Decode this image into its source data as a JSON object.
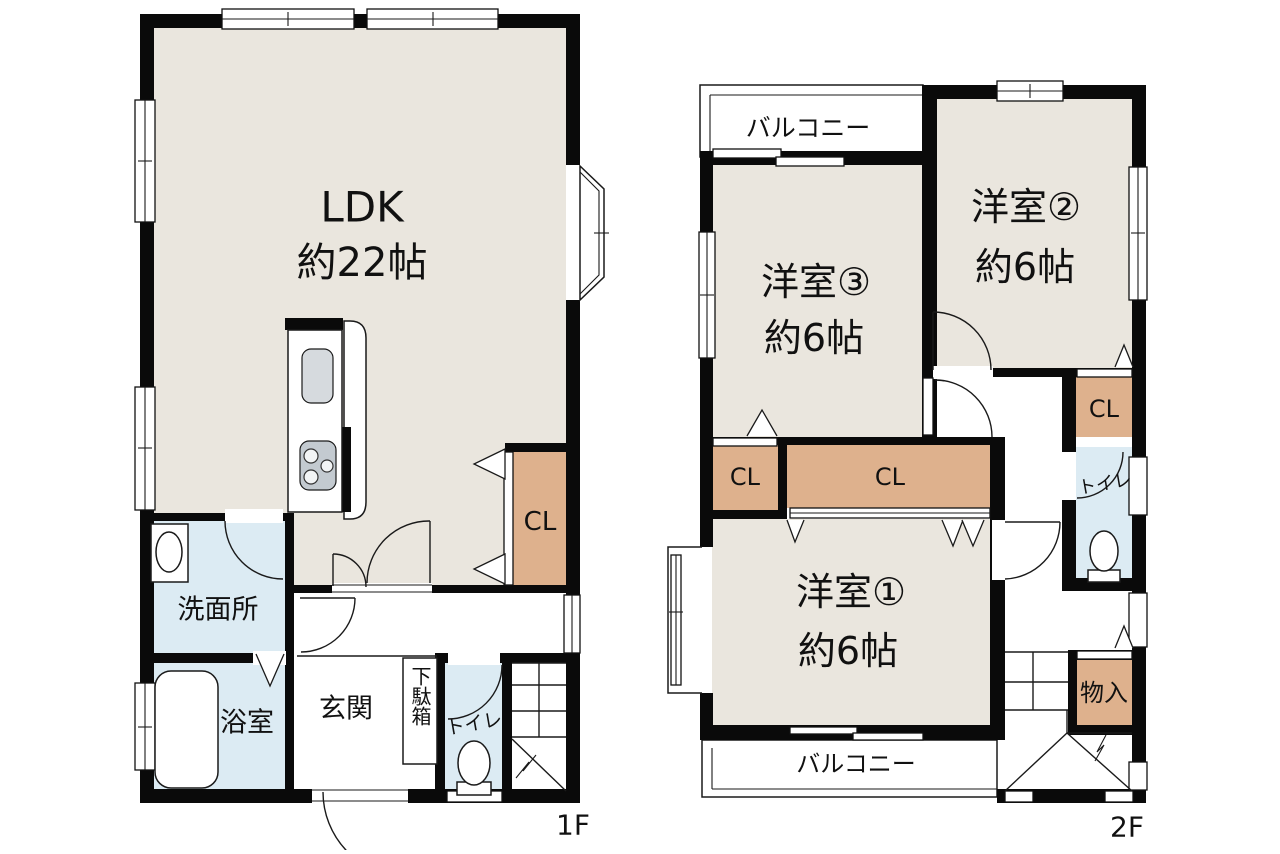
{
  "colors": {
    "bg": "#ffffff",
    "wall": "#0a0a0a",
    "room": "#eae6de",
    "wet": "#dcebf3",
    "closet": "#deb18d",
    "fixture_grey": "#c3cad0"
  },
  "floor1": {
    "floor_label": "1F",
    "ldk_label": "LDK",
    "ldk_size": "約22帖",
    "washroom": "洗面所",
    "bath": "浴室",
    "entrance": "玄関",
    "shoe_cabinet": "下駄箱",
    "toilet": "トイレ",
    "closet": "CL"
  },
  "floor2": {
    "floor_label": "2F",
    "balcony_top": "バルコニー",
    "balcony_bottom": "バルコニー",
    "room3": "洋室③",
    "room3_size": "約6帖",
    "room2": "洋室②",
    "room2_size": "約6帖",
    "room1": "洋室①",
    "room1_size": "約6帖",
    "closet_left": "CL",
    "closet_center": "CL",
    "closet_right": "CL",
    "toilet": "トイレ",
    "storage": "物入",
    "stairs": ""
  }
}
